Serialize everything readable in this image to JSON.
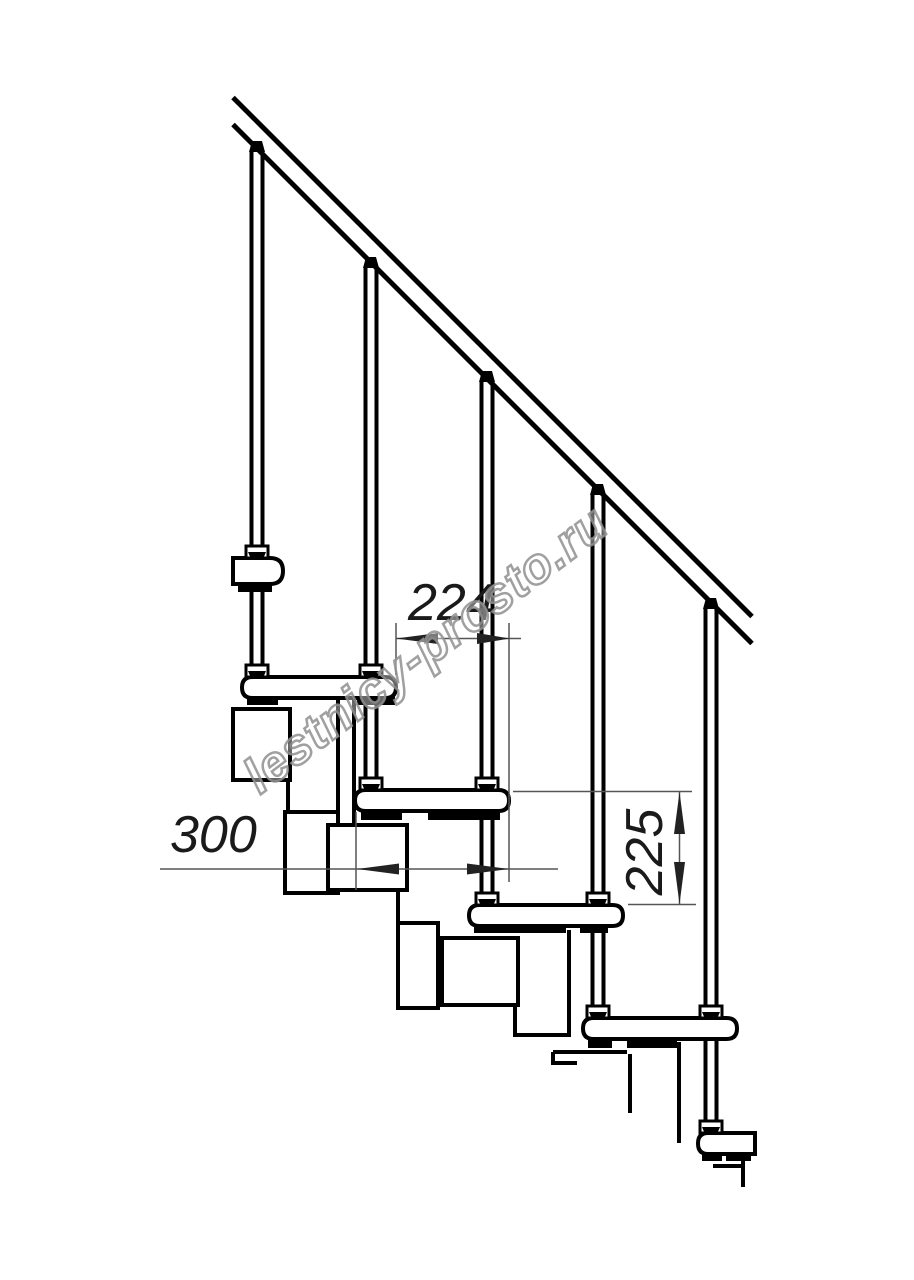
{
  "dimensions": {
    "run": "224",
    "depth": "300",
    "rise": "225"
  },
  "watermark": "lestnicy-prosto.ru",
  "colors": {
    "line": "#000000",
    "dimension_line": "#555555",
    "dimension_arrow": "#222222",
    "dimension_text": "#1a1a1a",
    "watermark_outline": "#8f8f8f",
    "background": "#ffffff"
  }
}
